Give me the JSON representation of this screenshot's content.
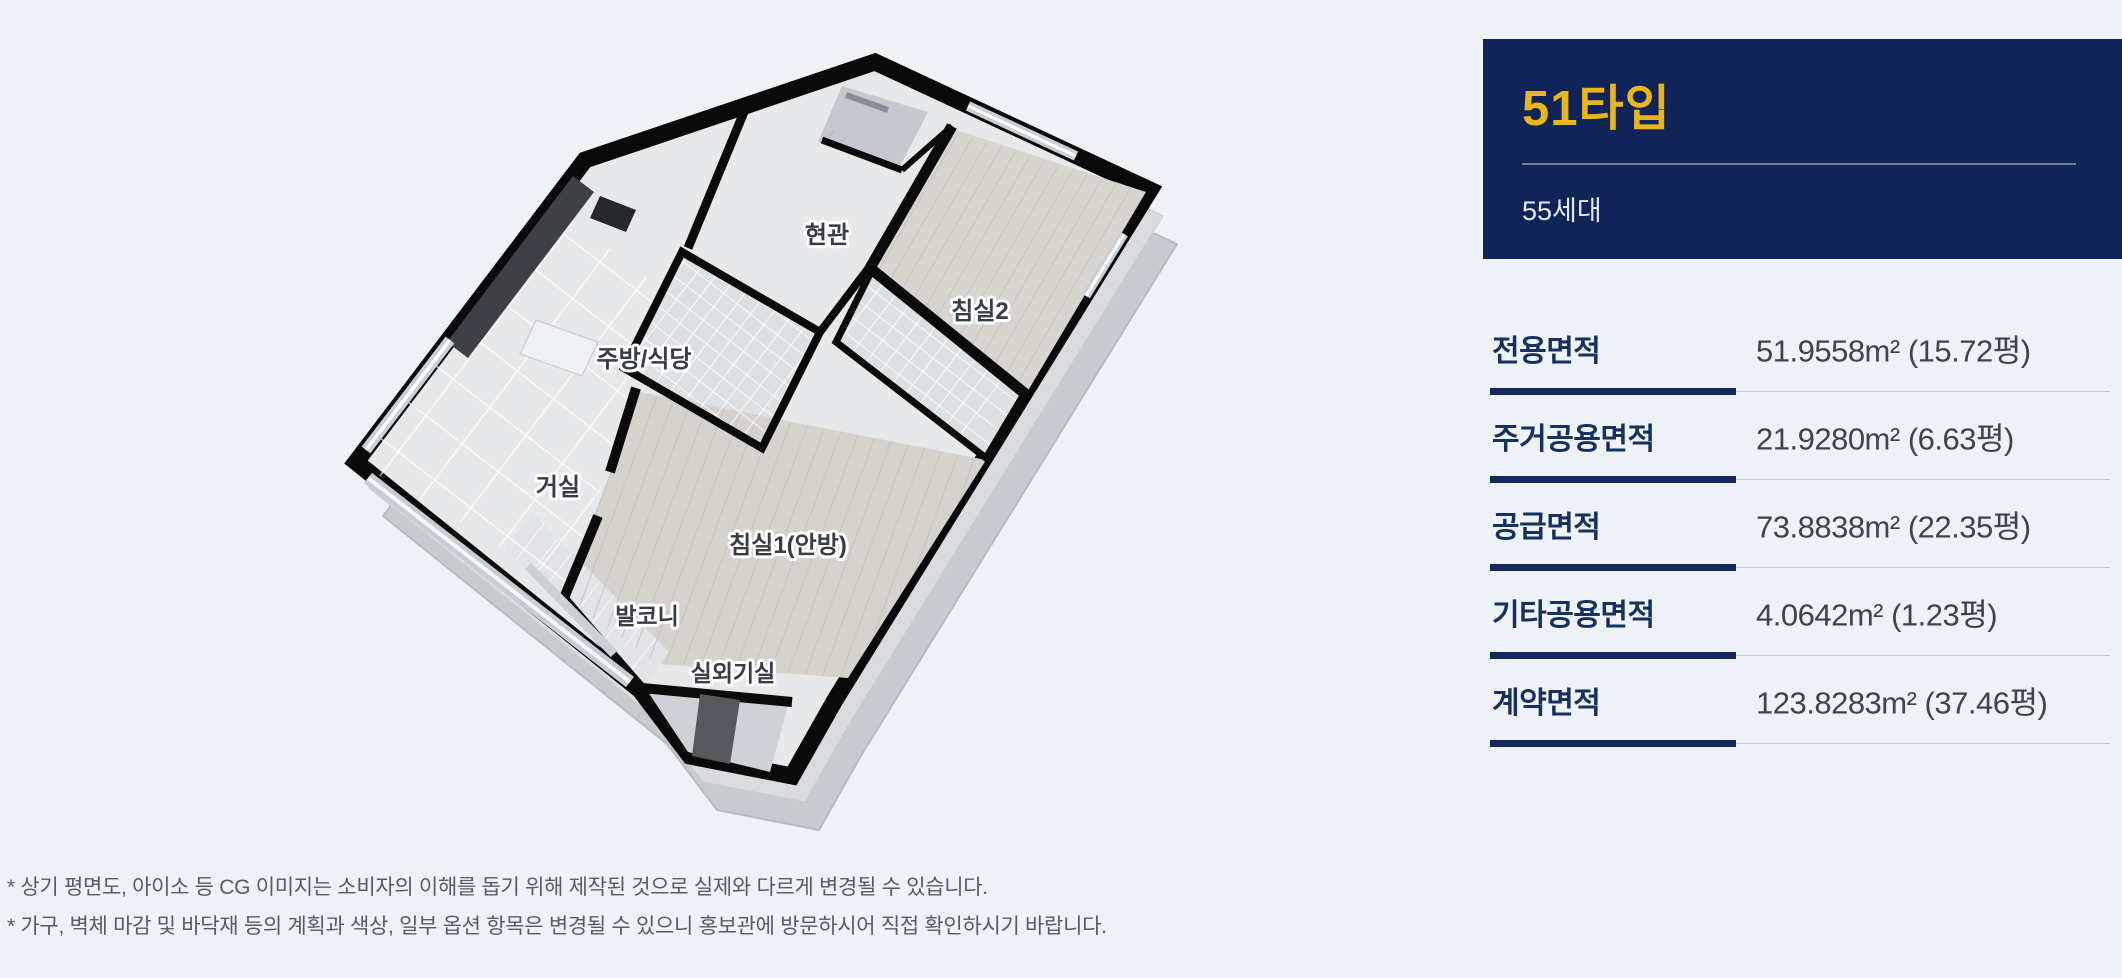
{
  "page": {
    "background": "#eef1f5"
  },
  "floor_plan": {
    "rooms": [
      {
        "name": "현관"
      },
      {
        "name": "침실2"
      },
      {
        "name": "주방/식당"
      },
      {
        "name": "거실"
      },
      {
        "name": "침실1(안방)"
      },
      {
        "name": "발코니"
      },
      {
        "name": "실외기실"
      }
    ],
    "wall_color": "#0a0a0b",
    "floor_color": "#e7e8ea"
  },
  "unit_card": {
    "type_label": "51타입",
    "households_label": "55세대",
    "background": "#112457",
    "accent": "#e9b51e"
  },
  "area_table": {
    "rows": [
      {
        "label": "전용면적",
        "value": "51.9558m² (15.72평)"
      },
      {
        "label": "주거공용면적",
        "value": "21.9280m² (6.63평)"
      },
      {
        "label": "공급면적",
        "value": "73.8838m² (22.35평)"
      },
      {
        "label": "기타공용면적",
        "value": "4.0642m² (1.23평)"
      },
      {
        "label": "계약면적",
        "value": "123.8283m² (37.46평)"
      }
    ]
  },
  "footnotes": [
    "* 상기 평면도, 아이소 등 CG 이미지는 소비자의 이해를 돕기 위해 제작된 것으로 실제와 다르게 변경될 수 있습니다.",
    "* 가구, 벽체 마감 및 바닥재 등의 계획과 색상, 일부 옵션 항목은 변경될 수 있으니 홍보관에 방문하시어 직접 확인하시기 바랍니다."
  ]
}
